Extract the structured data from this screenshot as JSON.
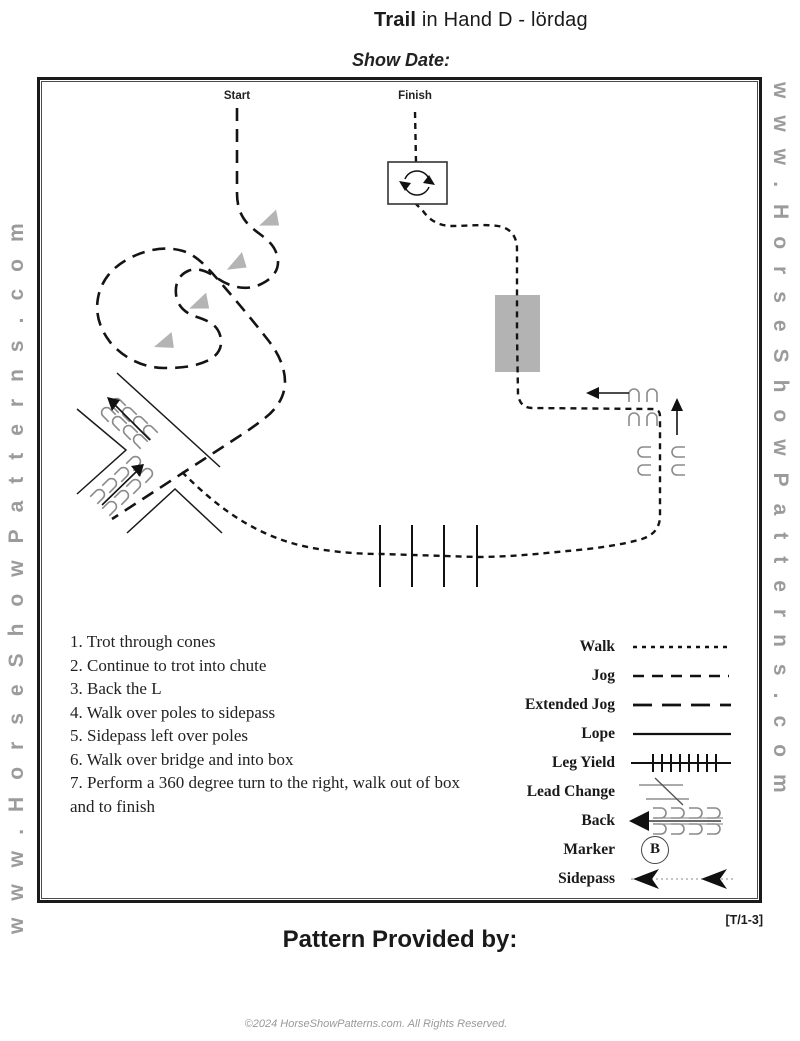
{
  "title": {
    "bold": "Trail",
    "rest": " in Hand D - lördag"
  },
  "show_date_label": "Show Date:",
  "watermarks": {
    "left": "www.HorseShowPatterns.com",
    "right": "www.HorseShowPatterns.com"
  },
  "arena": {
    "start_label": "Start",
    "finish_label": "Finish"
  },
  "instructions": [
    "1. Trot through cones",
    "2. Continue to trot into chute",
    "3. Back the L",
    "4. Walk over poles to sidepass",
    "5. Sidepass left over poles",
    "6. Walk over bridge and into box",
    "7. Perform a 360 degree turn to the right, walk out of box and to finish"
  ],
  "legend": [
    {
      "label": "Walk",
      "symbol": "walk-dashed-line"
    },
    {
      "label": "Jog",
      "symbol": "jog-dashed-line"
    },
    {
      "label": "Extended Jog",
      "symbol": "extended-jog-dashed-line"
    },
    {
      "label": "Lope",
      "symbol": "lope-solid-line"
    },
    {
      "label": "Leg Yield",
      "symbol": "leg-yield-crosshatch-line"
    },
    {
      "label": "Lead Change",
      "symbol": "lead-change-slash"
    },
    {
      "label": "Back",
      "symbol": "back-hoofprints-arrow"
    },
    {
      "label": "Marker",
      "symbol": "marker-circle",
      "letter": "B"
    },
    {
      "label": "Sidepass",
      "symbol": "sidepass-arrows"
    }
  ],
  "footer": {
    "pattern_code": "[T/1-3]",
    "provided_by_label": "Pattern Provided by:",
    "copyright": "©2024 HorseShowPatterns.com. All Rights Reserved."
  },
  "colors": {
    "ink": "#1a1a1a",
    "watermark_gray": "#9b9b9b",
    "cone_gray": "#b4b4b4",
    "bridge_gray": "#b3b3b3",
    "hoofprint_gray": "#8a8a8a",
    "footer_gray": "#999999"
  }
}
